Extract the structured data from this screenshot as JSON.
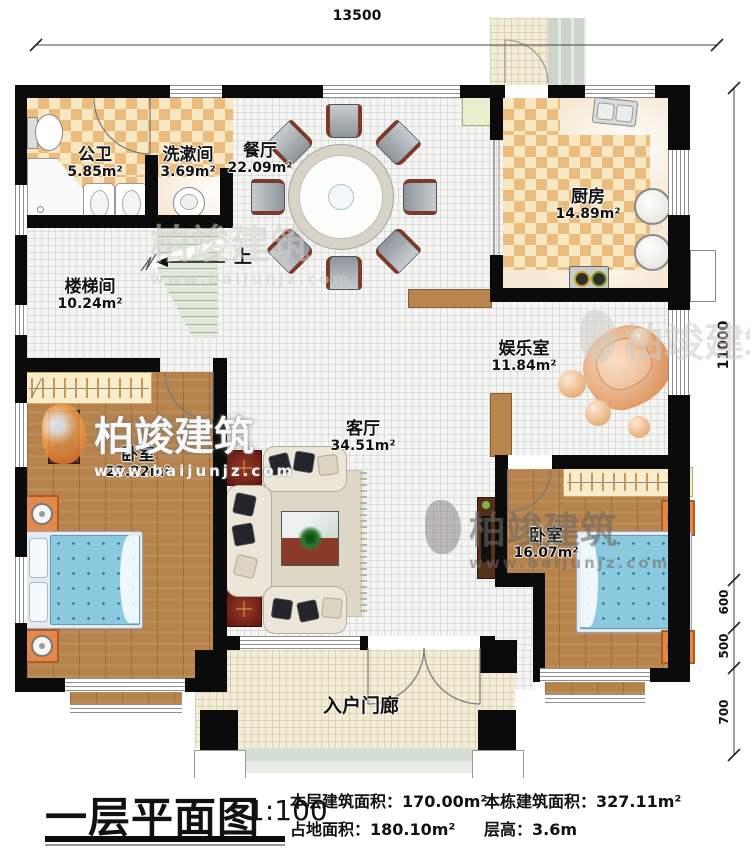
{
  "dimensions": {
    "top": "13500",
    "right_total": "11000",
    "right_seg_a": "600",
    "right_seg_b": "500",
    "right_seg_c": "700"
  },
  "rooms": {
    "bathroom": {
      "name": "公卫",
      "area": "5.85m²"
    },
    "washroom": {
      "name": "洗漱间",
      "area": "3.69m²"
    },
    "dining": {
      "name": "餐厅",
      "area": "22.09m²"
    },
    "kitchen": {
      "name": "厨房",
      "area": "14.89m²"
    },
    "stairwell": {
      "name": "楼梯间",
      "area": "10.24m²"
    },
    "recreation": {
      "name": "娱乐室",
      "area": "11.84m²"
    },
    "living": {
      "name": "客厅",
      "area": "34.51m²"
    },
    "bedroom1": {
      "name": "卧室",
      "area": "23.22m²"
    },
    "bedroom2": {
      "name": "卧室",
      "area": "16.07m²"
    },
    "porch": {
      "name": "入户门廊"
    }
  },
  "stairs": {
    "up_label": "上"
  },
  "watermark": {
    "brand": "柏竣建筑",
    "url": "www.baijunjz.com"
  },
  "title": {
    "text": "一层平面图",
    "scale": "1:100"
  },
  "stats": {
    "floor_area_label": "本层建筑面积：",
    "floor_area_value": "170.00m²",
    "site_area_label": "占地面积：",
    "site_area_value": "180.10m²",
    "total_area_label": "本栋建筑面积：",
    "total_area_value": "327.11m²",
    "storey_height_label": "层高：",
    "storey_height_value": "3.6m"
  },
  "colors": {
    "wall": "#0b0b0b",
    "checker_dark": "#eabc7d",
    "checker_light": "#f9e7c1",
    "wood": "#b6834c",
    "bed_blue": "#8ac9de",
    "accent_red": "#7c241a"
  }
}
